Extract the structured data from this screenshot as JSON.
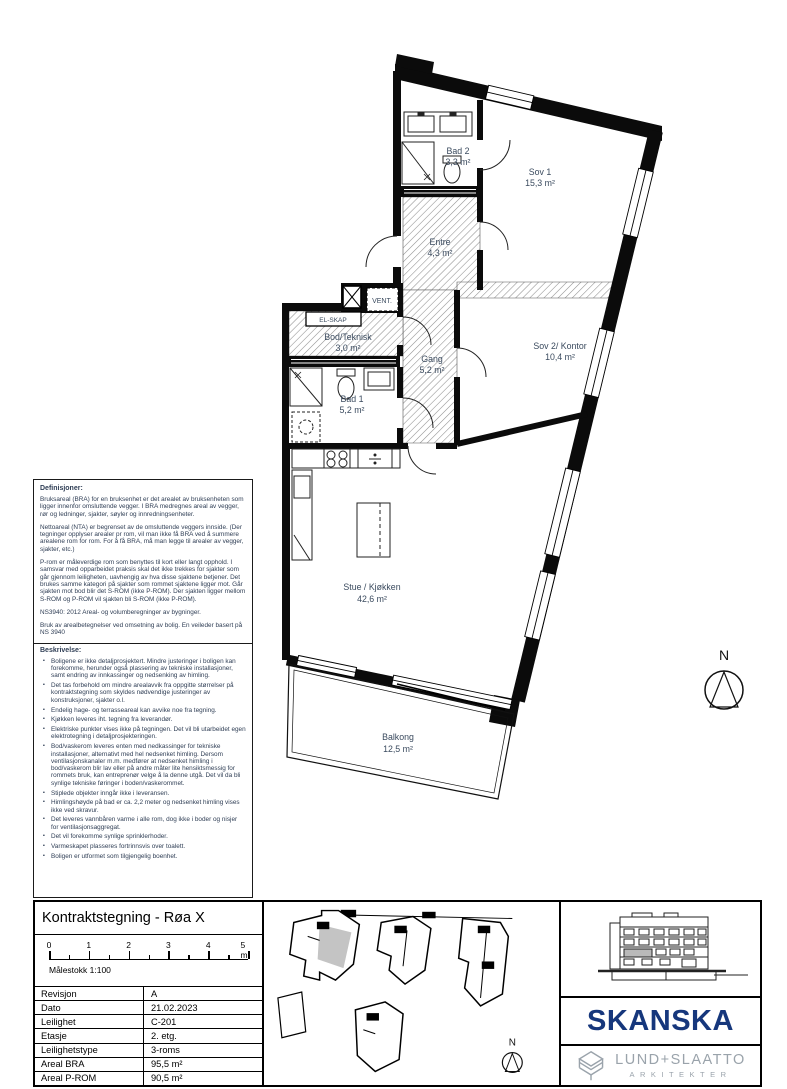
{
  "plan": {
    "rooms": {
      "bad2": {
        "name": "Bad 2",
        "area": "3,3 m²"
      },
      "sov1": {
        "name": "Sov 1",
        "area": "15,3 m²"
      },
      "entre": {
        "name": "Entre",
        "area": "4,3 m²"
      },
      "bod": {
        "name": "Bod/Teknisk",
        "area": "3,0 m²"
      },
      "gang": {
        "name": "Gang",
        "area": "5,2 m²"
      },
      "sov2": {
        "name": "Sov 2/ Kontor",
        "area": "10,4 m²"
      },
      "bad1": {
        "name": "Bad 1",
        "area": "5,2 m²"
      },
      "stue": {
        "name": "Stue / Kjøkken",
        "area": "42,6 m²"
      },
      "balkong": {
        "name": "Balkong",
        "area": "12,5 m²"
      }
    },
    "labels": {
      "vent": "VENT.",
      "el_skap": "EL-SKAP",
      "north": "N"
    }
  },
  "definitions_panel": {
    "definitions_title": "Definisjoner:",
    "definitions_paragraphs": [
      "Bruksareal (BRA) for en bruksenhet er det arealet av bruksenheten som ligger innenfor omsluttende vegger. I BRA medregnes areal av vegger, rør og ledninger, sjakter, søyler og innredningsenheter.",
      "Nettoareal (NTA) er begrenset av de omsluttende veggers innside. (Der tegninger opplyser arealer pr rom, vil man ikke få BRA ved å summere arealene rom for rom. For å få BRA, må man legge til arealer av vegger, sjakter, etc.)",
      "P-rom er måleverdige rom som benyttes til kort eller langt opphold. I samsvar med opparbeidet praksis skal det ikke trekkes for sjakter som går gjennom leiligheten, uavhengig av hva disse sjaktene betjener. Det brukes samme kategori på sjakter som rommet sjaktene ligger mot. Går sjakten mot bod blir det S-ROM (ikke P-ROM). Der sjakten ligger mellom S-ROM og P-ROM vil sjakten bli S-ROM (ikke P-ROM).",
      "NS3940: 2012 Areal- og volumberegninger av bygninger.",
      "Bruk av arealbetegnelser ved omsetning av bolig. En veileder basert på NS 3940"
    ],
    "description_title": "Beskrivelse:",
    "description_bullets": [
      "Boligene er ikke detaljprosjektert. Mindre justeringer i boligen kan forekomme, herunder også plassering av tekniske installasjoner, samt endring av innkassinger og nedsenking av himling.",
      "Det tas forbehold om mindre arealavvik fra oppgitte størrelser på kontraktstegning som skyldes nødvendige justeringer av konstruksjoner, sjakter o.l.",
      "Endelig hage- og terrasseareal kan avvike noe fra tegning.",
      "Kjøkken leveres iht. tegning fra leverandør.",
      "Elektriske punkter vises ikke på tegningen. Det vil bli utarbeidet egen elektrotegning i detaljprosjekteringen.",
      "Bod/vaskerom leveres enten med nedkassinger for tekniske installasjoner, alternativt med hel nedsenket himling. Dersom ventilasjonskanaler m.m. medfører at nedsenket himling i bod/vaskerom blir lav eller på andre måter lite hensiktsmessig for rommets bruk, kan entreprenør velge å la denne utgå. Det vil da bli synlige tekniske føringer i boden/vaskerommet.",
      "Stiplede objekter inngår ikke i leveransen.",
      "Himlingshøyde på bad er ca. 2,2 meter og nedsenket himling vises ikke ved skravur.",
      "Det leveres vannbåren varme i alle rom, dog ikke i boder og nisjer for ventilasjonsaggregat.",
      "Det vil forekomme synlige sprinklerhoder.",
      "Varmeskapet plasseres fortrinnsvis over toalett.",
      "Boligen er utformet som tilgjengelig boenhet."
    ]
  },
  "titleblock": {
    "title": "Kontraktstegning - Røa X",
    "scale_ticks": [
      "0",
      "1",
      "2",
      "3",
      "4",
      "5 m"
    ],
    "scale_label": "Målestokk  1:100",
    "rows": [
      {
        "label": "Revisjon",
        "value": "A"
      },
      {
        "label": "Dato",
        "value": "21.02.2023"
      },
      {
        "label": "Leilighet",
        "value": "C-201"
      },
      {
        "label": "Etasje",
        "value": "2. etg."
      },
      {
        "label": "Leilighetstype",
        "value": "3-roms"
      },
      {
        "label": "Areal BRA",
        "value": "95,5 m²"
      },
      {
        "label": "Areal P-ROM",
        "value": "90,5 m²"
      }
    ],
    "keyplan_north": "N"
  },
  "branding": {
    "skanska": "SKANSKA",
    "architect_name": "LUND+SLAATTO",
    "architect_sub": "ARKITEKTER",
    "skanska_blue": "#16377c",
    "architect_gray": "#9aa3ab",
    "keyplan_highlight": "#c4c4c4"
  }
}
